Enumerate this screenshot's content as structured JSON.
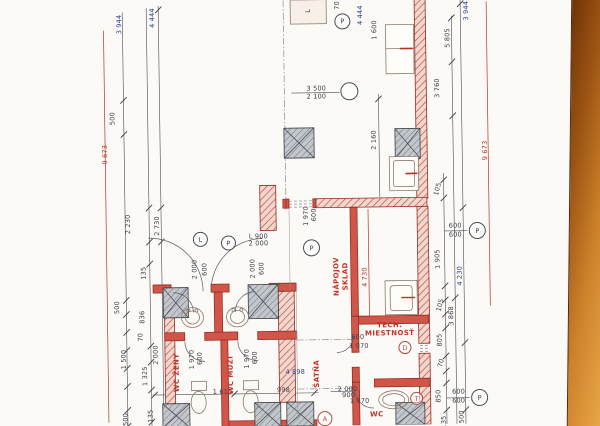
{
  "plan": {
    "colors": {
      "dim_dark": "#3c3c46",
      "dim_blue": "#2b3f92",
      "dim_red": "#b23527",
      "room_red": "#c03328",
      "wall_red": "#962c22"
    },
    "dim_labels": [
      {
        "t": "3 944",
        "x": 122,
        "y": 22,
        "r": -90,
        "c": "b"
      },
      {
        "t": "4 444",
        "x": 155,
        "y": 16,
        "r": -90,
        "c": "b"
      },
      {
        "t": "9 673",
        "x": 106,
        "y": 152,
        "r": -90,
        "c": "r"
      },
      {
        "t": "500",
        "x": 114,
        "y": 116,
        "r": -90,
        "c": "k"
      },
      {
        "t": "2 230",
        "x": 128,
        "y": 222,
        "r": -90,
        "c": "k"
      },
      {
        "t": "2 730",
        "x": 157,
        "y": 224,
        "r": -90,
        "c": "k"
      },
      {
        "t": "135",
        "x": 143,
        "y": 271,
        "r": -90,
        "c": "k"
      },
      {
        "t": "500",
        "x": 116,
        "y": 305,
        "r": -90,
        "c": "k"
      },
      {
        "t": "836",
        "x": 141,
        "y": 315,
        "r": -90,
        "c": "k"
      },
      {
        "t": "70",
        "x": 139,
        "y": 335,
        "r": -90,
        "c": "k"
      },
      {
        "t": "1 500",
        "x": 122,
        "y": 357,
        "r": -90,
        "c": "k"
      },
      {
        "t": "2 000",
        "x": 154,
        "y": 353,
        "r": -90,
        "c": "k"
      },
      {
        "t": "1 325",
        "x": 143,
        "y": 374,
        "r": -90,
        "c": "k"
      },
      {
        "t": "135",
        "x": 148,
        "y": 414,
        "r": -90,
        "c": "k"
      },
      {
        "t": "500",
        "x": 123,
        "y": 417,
        "r": -90,
        "c": "k"
      },
      {
        "t": "L",
        "x": 311,
        "y": 11,
        "r": -90,
        "c": "k"
      },
      {
        "t": "70",
        "x": 340,
        "y": 6,
        "r": -90,
        "c": "k"
      },
      {
        "t": "4 444",
        "x": 363,
        "y": 16,
        "r": -90,
        "c": "b"
      },
      {
        "t": "1 600",
        "x": 377,
        "y": 31,
        "r": -90,
        "c": "k"
      },
      {
        "t": "3 500",
        "x": 318,
        "y": 89,
        "r": 0,
        "c": "k"
      },
      {
        "t": "2 100",
        "x": 318,
        "y": 97,
        "r": 0,
        "c": "k"
      },
      {
        "t": "2 160",
        "x": 375,
        "y": 141,
        "r": -90,
        "c": "k"
      },
      {
        "t": "3 944",
        "x": 469,
        "y": 13,
        "r": -90,
        "c": "b"
      },
      {
        "t": "5 805",
        "x": 450,
        "y": 40,
        "r": -90,
        "c": "k"
      },
      {
        "t": "3 760",
        "x": 439,
        "y": 90,
        "r": -90,
        "c": "k"
      },
      {
        "t": "9 673",
        "x": 486,
        "y": 153,
        "r": -90,
        "c": "r"
      },
      {
        "t": "105",
        "x": 438,
        "y": 191,
        "r": -75,
        "c": "k"
      },
      {
        "t": "600",
        "x": 455,
        "y": 228,
        "r": 0,
        "c": "k"
      },
      {
        "t": "600",
        "x": 455,
        "y": 237,
        "r": 0,
        "c": "k"
      },
      {
        "t": "1 905",
        "x": 437,
        "y": 261,
        "r": -90,
        "c": "k"
      },
      {
        "t": "4 230",
        "x": 459,
        "y": 278,
        "r": -90,
        "c": "b"
      },
      {
        "t": "4 730",
        "x": 364,
        "y": 278,
        "r": -90,
        "c": "r"
      },
      {
        "t": "105",
        "x": 439,
        "y": 307,
        "r": -75,
        "c": "k"
      },
      {
        "t": "3 868",
        "x": 450,
        "y": 318,
        "r": -90,
        "c": "k"
      },
      {
        "t": "805",
        "x": 438,
        "y": 342,
        "r": -90,
        "c": "k"
      },
      {
        "t": "70",
        "x": 439,
        "y": 365,
        "r": -75,
        "c": "k"
      },
      {
        "t": "850",
        "x": 436,
        "y": 398,
        "r": -90,
        "c": "k"
      },
      {
        "t": "600",
        "x": 456,
        "y": 394,
        "r": 0,
        "c": "k"
      },
      {
        "t": "600",
        "x": 456,
        "y": 403,
        "r": 0,
        "c": "k"
      },
      {
        "t": "500",
        "x": 459,
        "y": 419,
        "r": -90,
        "c": "k"
      },
      {
        "t": "135",
        "x": 441,
        "y": 424,
        "r": -90,
        "c": "k"
      },
      {
        "t": "600",
        "x": 314,
        "y": 215,
        "r": -90,
        "c": "k"
      },
      {
        "t": "1 970",
        "x": 306,
        "y": 216,
        "r": -90,
        "c": "k"
      },
      {
        "t": "L 900",
        "x": 258,
        "y": 236,
        "r": 0,
        "c": "k"
      },
      {
        "t": "2 000",
        "x": 258,
        "y": 243,
        "r": 0,
        "c": "k"
      },
      {
        "t": "2 000",
        "x": 194,
        "y": 268,
        "r": -90,
        "c": "k"
      },
      {
        "t": "600",
        "x": 204,
        "y": 268,
        "r": -90,
        "c": "k"
      },
      {
        "t": "2 000",
        "x": 252,
        "y": 268,
        "r": -90,
        "c": "k"
      },
      {
        "t": "600",
        "x": 261,
        "y": 268,
        "r": -90,
        "c": "k"
      },
      {
        "t": "600",
        "x": 198,
        "y": 357,
        "r": -90,
        "c": "k"
      },
      {
        "t": "1 970",
        "x": 190,
        "y": 358,
        "r": -90,
        "c": "k"
      },
      {
        "t": "600",
        "x": 253,
        "y": 357,
        "r": -90,
        "c": "k"
      },
      {
        "t": "1 970",
        "x": 245,
        "y": 358,
        "r": -90,
        "c": "k"
      },
      {
        "t": "1 613",
        "x": 220,
        "y": 391,
        "r": 0,
        "c": "k"
      },
      {
        "t": "998",
        "x": 281,
        "y": 390,
        "r": 0,
        "c": "k"
      },
      {
        "t": "4 898",
        "x": 293,
        "y": 372,
        "r": 0,
        "c": "b"
      },
      {
        "t": "600",
        "x": 356,
        "y": 338,
        "r": 0,
        "c": "k"
      },
      {
        "t": "1 970",
        "x": 357,
        "y": 347,
        "r": 0,
        "c": "k"
      },
      {
        "t": "2 000",
        "x": 345,
        "y": 390,
        "r": 0,
        "c": "k"
      },
      {
        "t": "900",
        "x": 346,
        "y": 396,
        "r": 0,
        "c": "k"
      },
      {
        "t": "1 970",
        "x": 357,
        "y": 402,
        "r": 0,
        "c": "k"
      }
    ],
    "room_labels": [
      {
        "t": "WC ŽENY",
        "x": 175,
        "y": 371,
        "r": -90
      },
      {
        "t": "WC MUŽI",
        "x": 229,
        "y": 374,
        "r": -90
      },
      {
        "t": "ŠATŇA",
        "x": 315,
        "y": 374,
        "r": -90
      },
      {
        "t": "SKLAD",
        "x": 345,
        "y": 277,
        "r": -90
      },
      {
        "t": "NÁPOJOV",
        "x": 336,
        "y": 277,
        "r": -90
      },
      {
        "t": "TECH.",
        "x": 388,
        "y": 327,
        "r": 0
      },
      {
        "t": "MIESTNOSŤ",
        "x": 388,
        "y": 335,
        "r": 0
      },
      {
        "t": "WC",
        "x": 374,
        "y": 416,
        "r": 0
      }
    ],
    "markers": [
      {
        "t": "P",
        "x": 345,
        "y": 22,
        "d": 16
      },
      {
        "t": "",
        "x": 351,
        "y": 92,
        "d": 18
      },
      {
        "t": "P",
        "x": 311,
        "y": 248,
        "d": 17
      },
      {
        "t": "L",
        "x": 200,
        "y": 238,
        "d": 15
      },
      {
        "t": "P",
        "x": 228,
        "y": 242,
        "d": 15
      },
      {
        "t": "P",
        "x": 477,
        "y": 233,
        "d": 17
      },
      {
        "t": "P",
        "x": 477,
        "y": 400,
        "d": 17
      },
      {
        "t": "D",
        "x": 403,
        "y": 349,
        "d": 13,
        "c": "r"
      },
      {
        "t": "T",
        "x": 414,
        "y": 400,
        "d": 13,
        "c": "r"
      },
      {
        "t": "A",
        "x": 322,
        "y": 419,
        "d": 15,
        "c": "r"
      }
    ]
  }
}
